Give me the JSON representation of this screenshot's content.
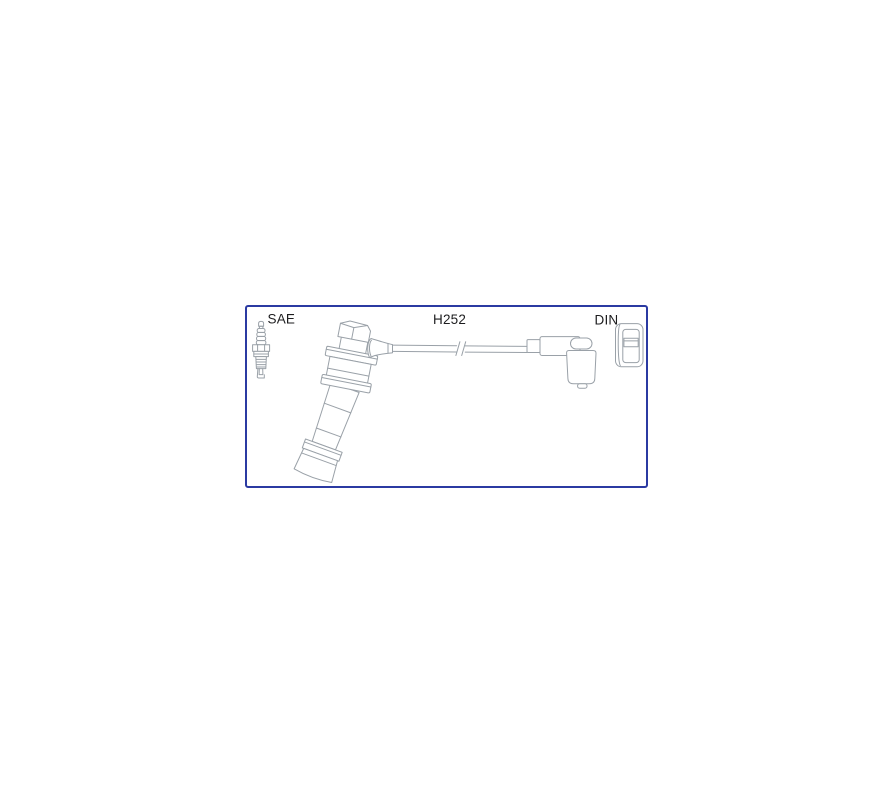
{
  "image": {
    "type": "product-diagram",
    "subject": "ignition-cable-kit",
    "labels": {
      "sae": "SAE",
      "part_number": "H252",
      "din": "DIN"
    },
    "colors": {
      "border": "#2b3aa2",
      "line": "#9aa1a8",
      "text": "#1d1d1f",
      "background": "#ffffff"
    },
    "components": {
      "left": "spark-plug",
      "center": "ignition-lead",
      "right": "din-connector"
    }
  }
}
